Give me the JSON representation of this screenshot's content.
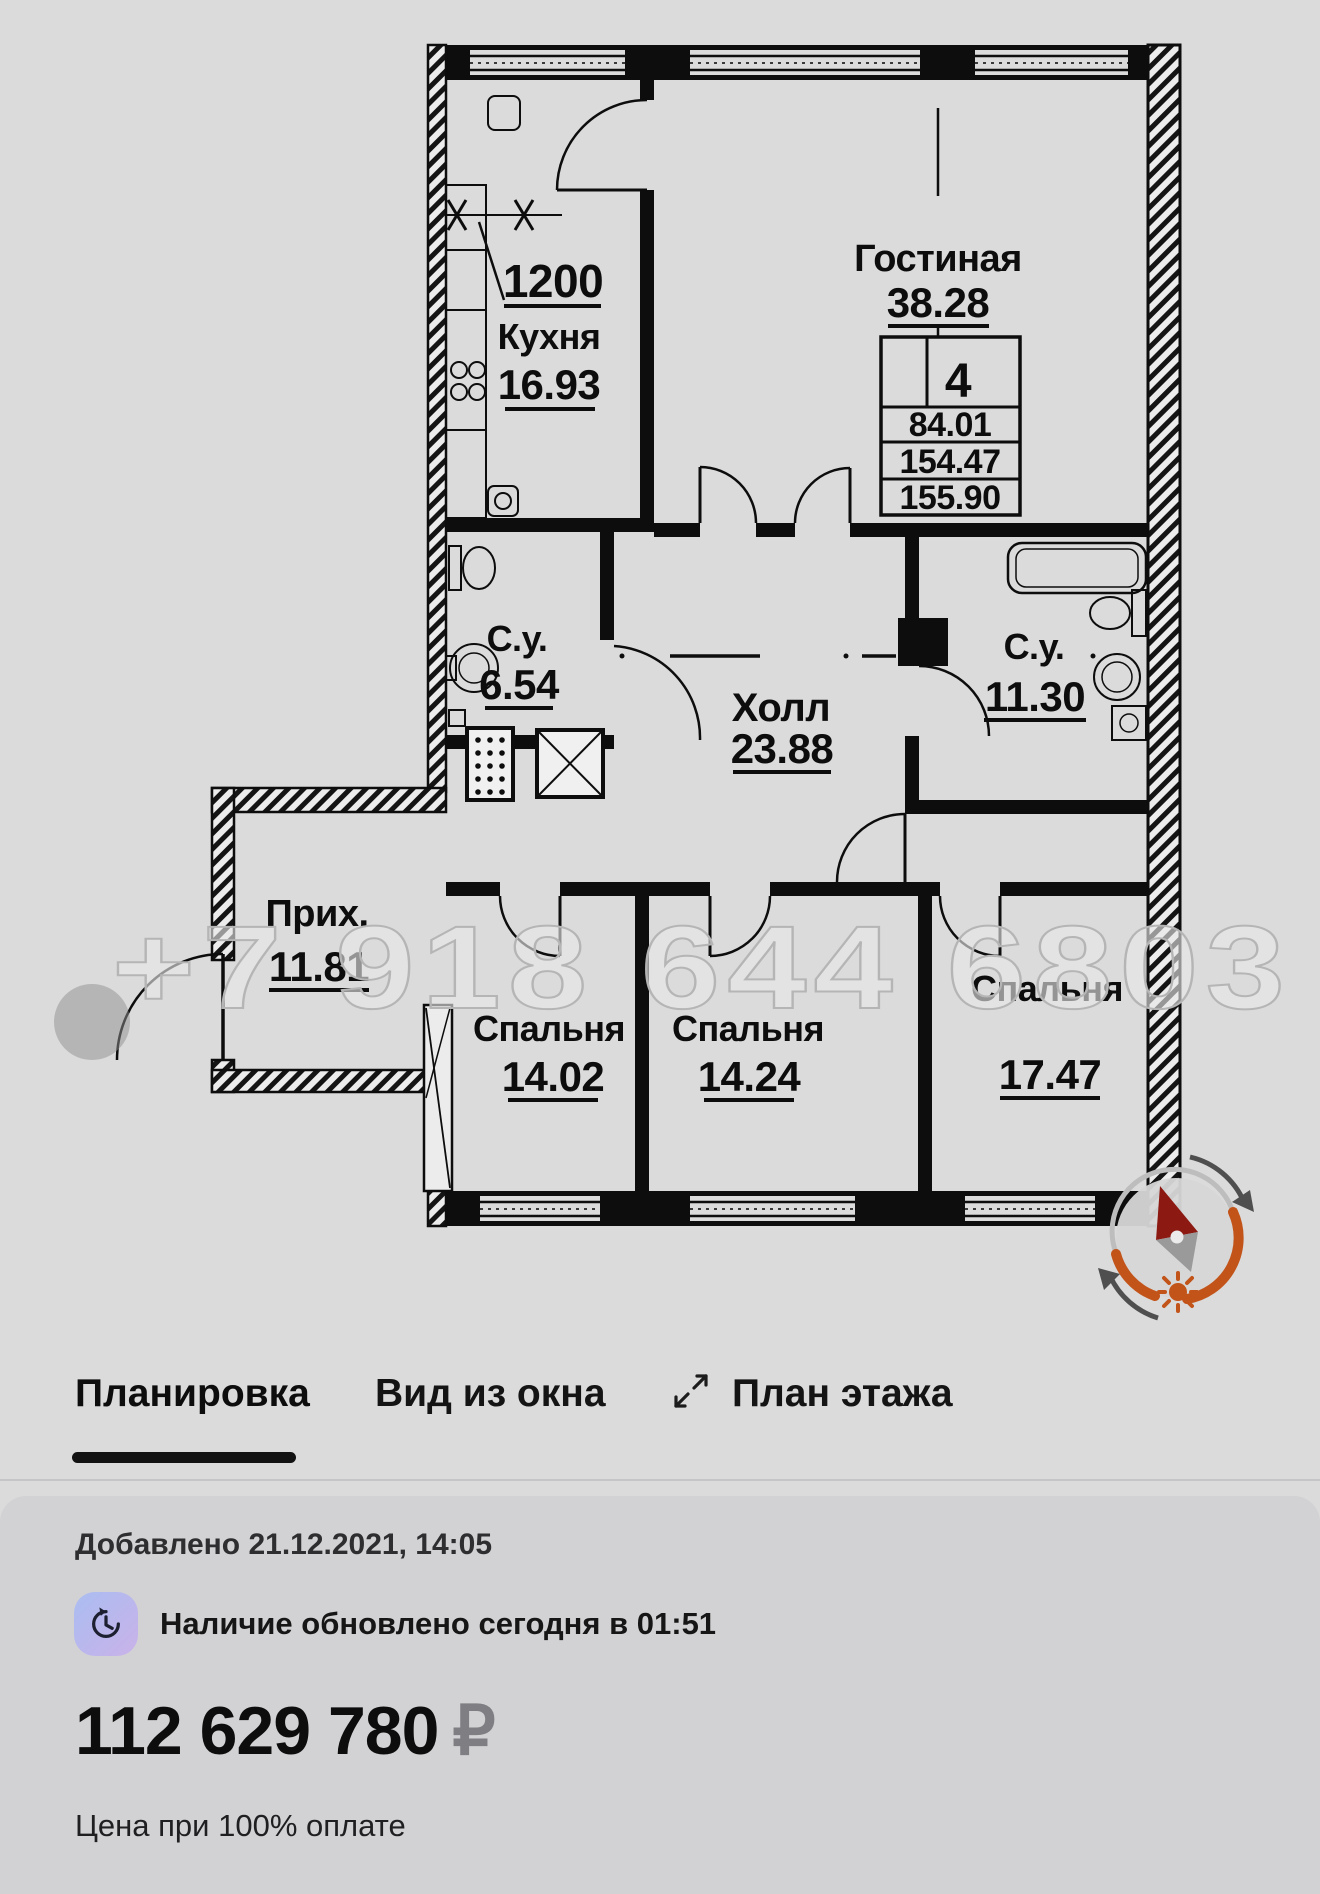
{
  "plan": {
    "watermark": "+7 918 644 6803",
    "dimension_label": "1200",
    "rooms": [
      {
        "name": "Кухня",
        "area": "16.93"
      },
      {
        "name": "Гостиная",
        "area": "38.28"
      },
      {
        "name": "С.у.",
        "area": "6.54"
      },
      {
        "name": "Холл",
        "area": "23.88"
      },
      {
        "name": "С.у.",
        "area": "11.30"
      },
      {
        "name": "Прих.",
        "area": "11.81"
      },
      {
        "name": "Спальня",
        "area": "14.02"
      },
      {
        "name": "Спальня",
        "area": "14.24"
      },
      {
        "name": "Спальня",
        "area": "17.47"
      }
    ],
    "summary_table": {
      "rooms_count": "4",
      "rows": [
        "84.01",
        "154.47",
        "155.90"
      ]
    }
  },
  "tabs": {
    "layout": "Планировка",
    "window_view": "Вид из окна",
    "floor_plan": "План этажа"
  },
  "details": {
    "added": "Добавлено 21.12.2021, 14:05",
    "availability": "Наличие обновлено сегодня в 01:51",
    "price": "112 629 780",
    "currency": "₽",
    "price_note": "Цена при 100% оплате"
  },
  "colors": {
    "page_bg": "#dbdbdb",
    "card_bg": "#d2d2d4",
    "plan_line": "#0d0d0d",
    "accent_orange": "#c2541a",
    "needle_red": "#8c1912",
    "active_tab_underline": "#121212",
    "icon_bg_start": "#aabdf1",
    "icon_bg_end": "#c9b2e9"
  }
}
